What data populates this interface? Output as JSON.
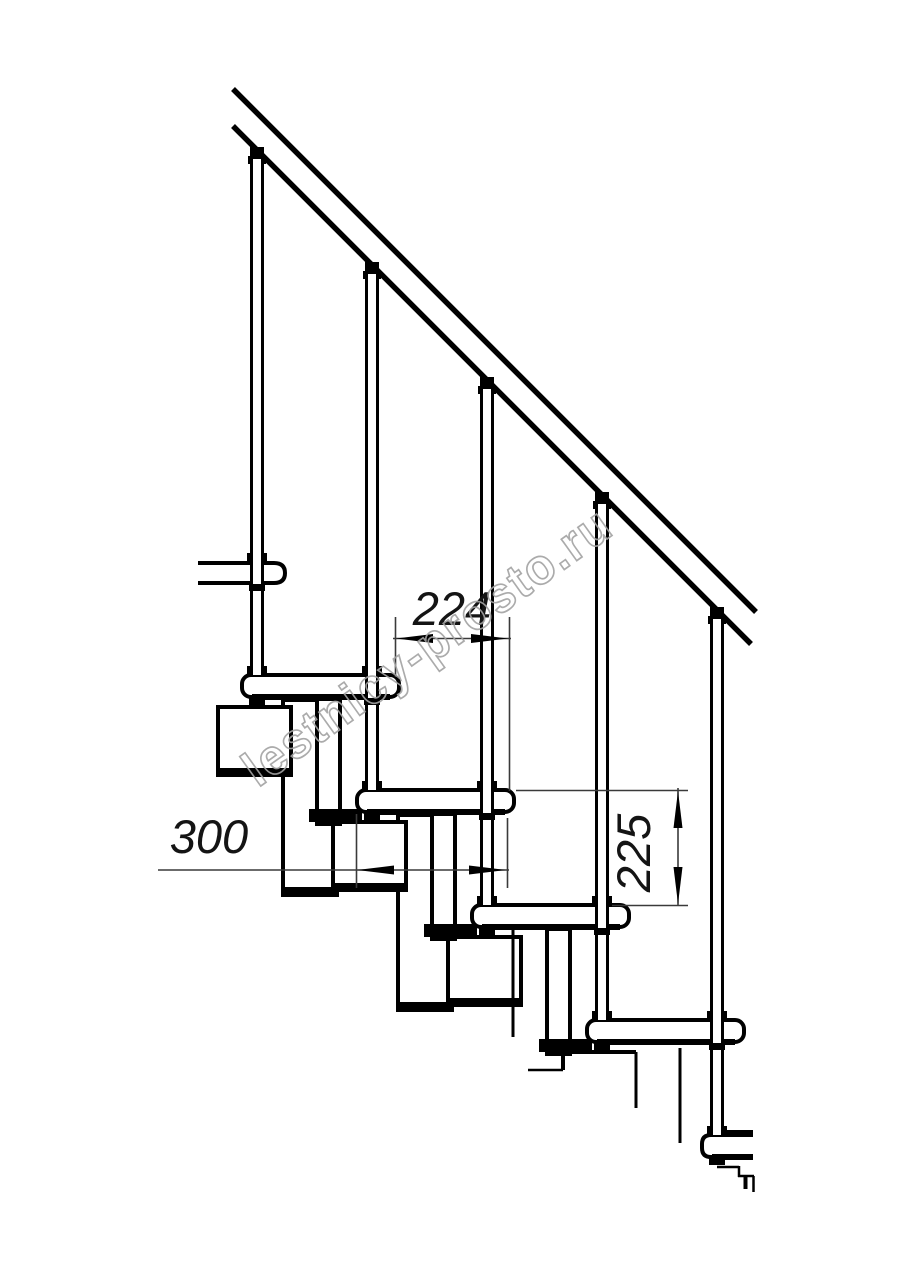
{
  "document": {
    "type": "technical-drawing",
    "subject": "modular staircase side view",
    "background": "#ffffff"
  },
  "watermark": {
    "text": "lestnicy-prosto.ru",
    "color": "#a2a2a2"
  },
  "dimensions": {
    "going": {
      "label": "224",
      "meaning": "horizontal step run between tread noses"
    },
    "tread_depth": {
      "label": "300",
      "meaning": "tread depth"
    },
    "riser": {
      "label": "225",
      "meaning": "vertical rise between treads"
    }
  },
  "drawing": {
    "line_color": "#000000",
    "dim_line_color": "#3a3a3a",
    "treads_visible": 5,
    "balusters_visible": 5
  }
}
